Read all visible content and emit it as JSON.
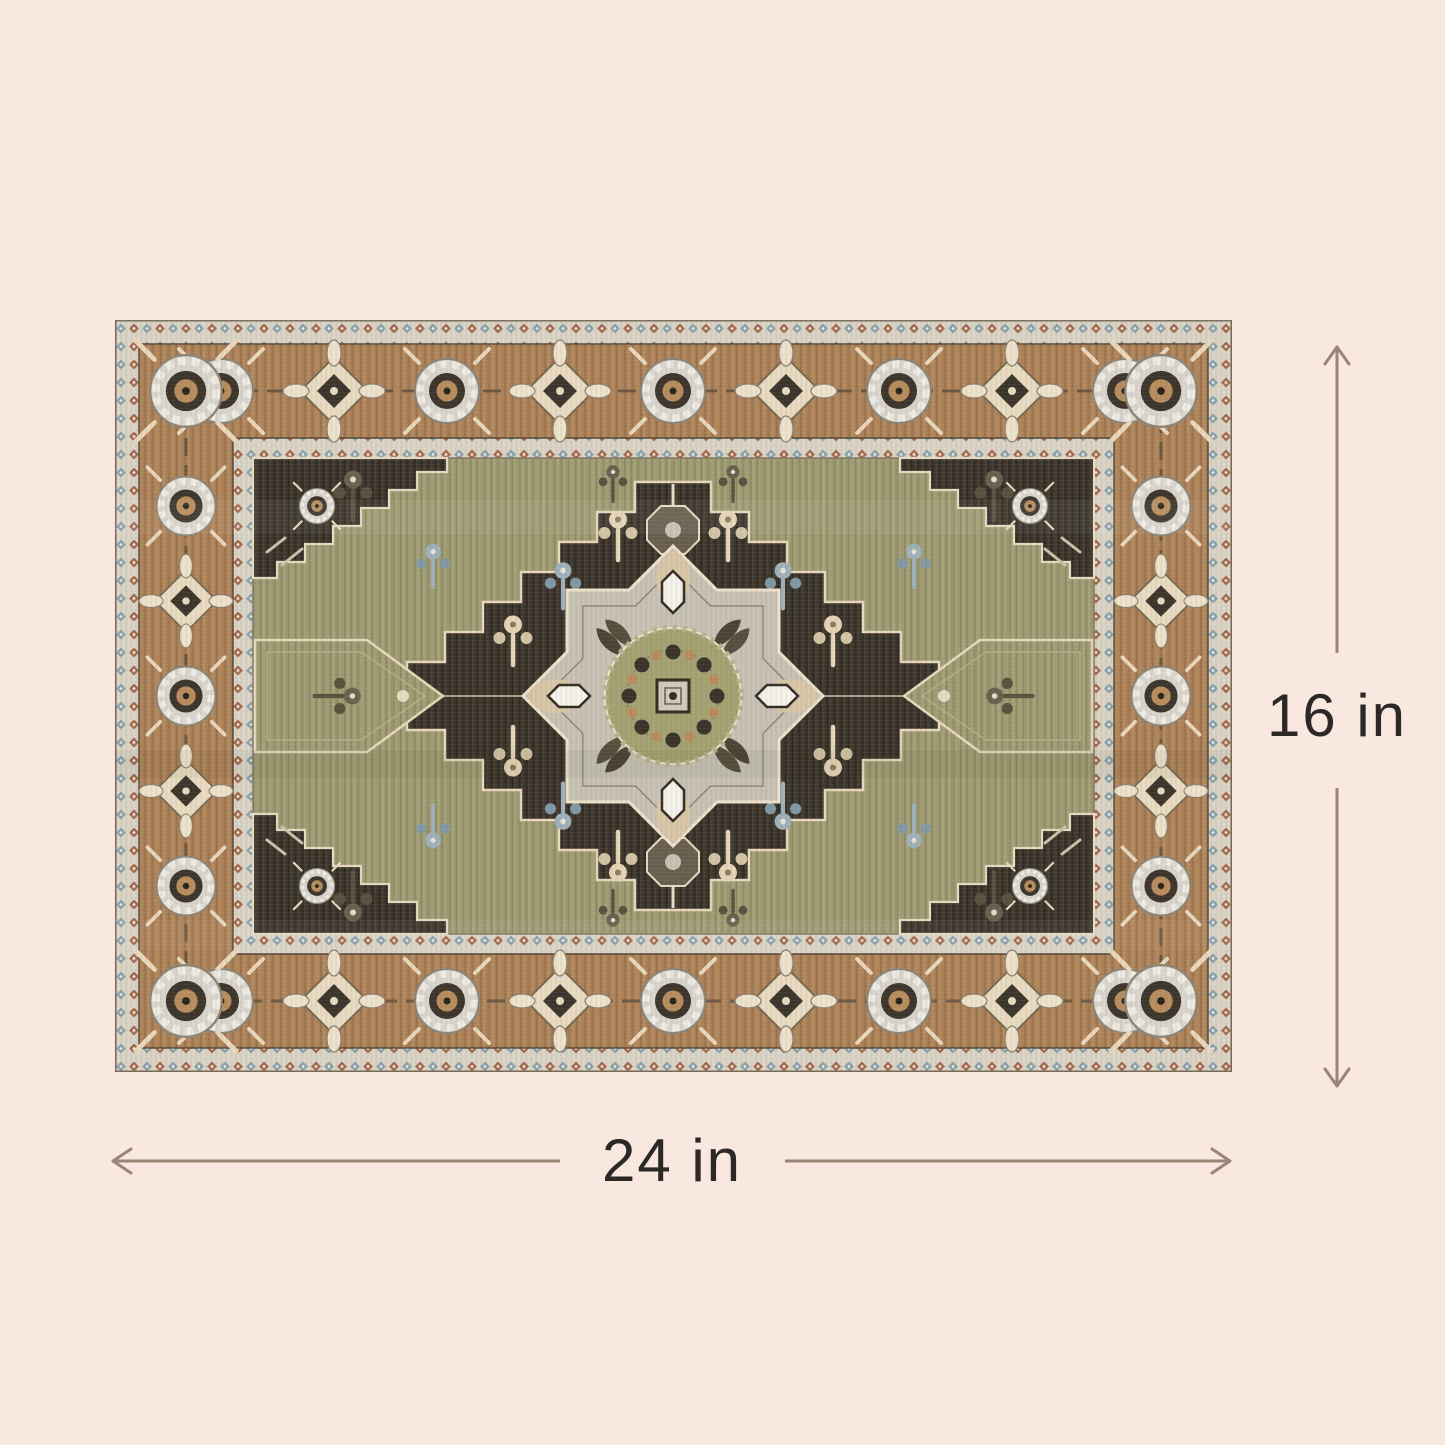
{
  "page": {
    "background_color": "#f8e8df",
    "type": "product-dimension-diagram"
  },
  "product": {
    "name": "medallion-area-rug"
  },
  "dimensions": {
    "height": {
      "label": "16 in",
      "value": 16,
      "unit": "in"
    },
    "width": {
      "label": "24 in",
      "value": 24,
      "unit": "in"
    },
    "arrow_color": "#9a8577",
    "label_color": "#2b2826"
  },
  "rug_palette": {
    "border_brown": "#ab8157",
    "field_olive": "#9c9970",
    "medallion_charcoal": "#3a342b",
    "motif_cream": "#ead9bd",
    "motif_gray": "#c8c3b5",
    "guard_cream": "#dbd5c6",
    "accent_blue": "#8aa2ae",
    "accent_brick": "#a46a4e",
    "rosette_tan": "#b98e5e"
  },
  "icons": {
    "up_arrow": "dimension arrow up",
    "down_arrow": "dimension arrow down",
    "left_arrow": "dimension arrow left",
    "right_arrow": "dimension arrow right"
  }
}
